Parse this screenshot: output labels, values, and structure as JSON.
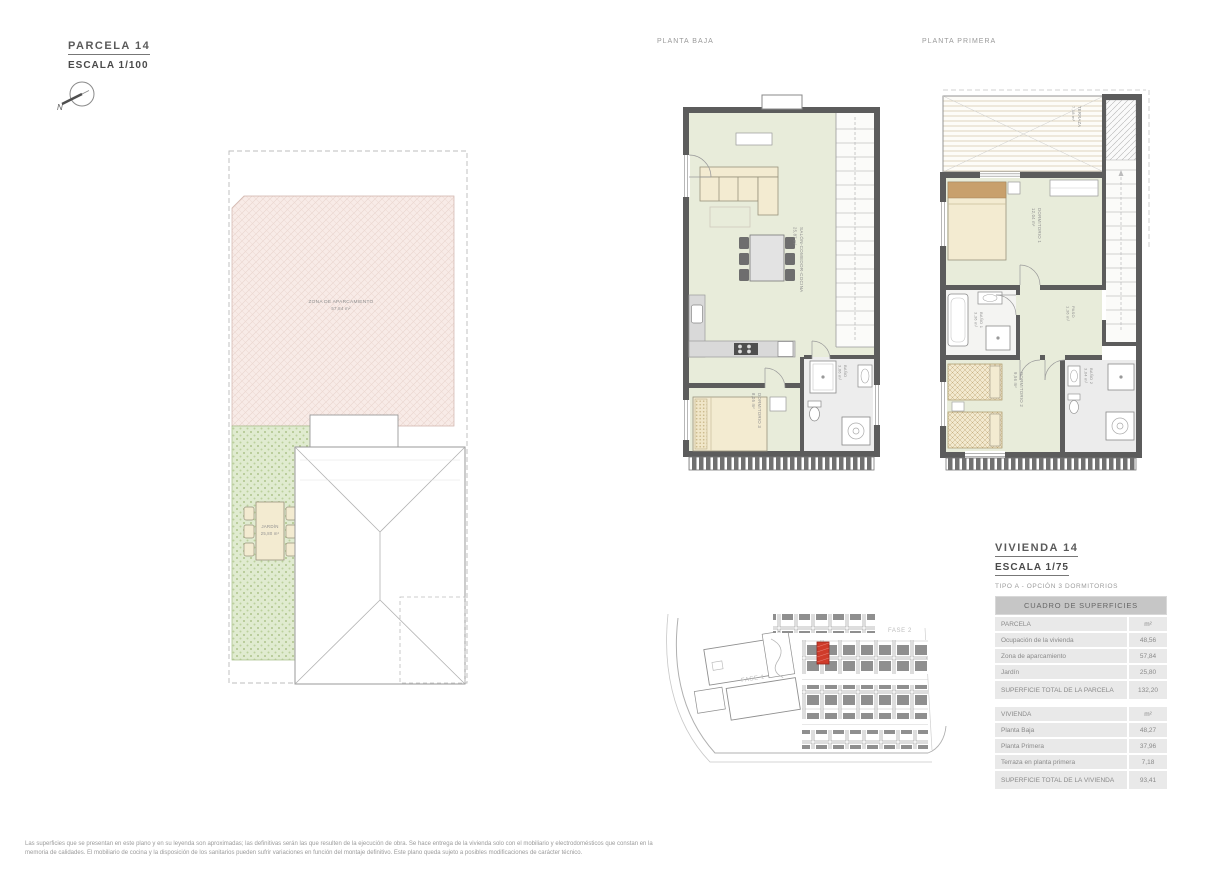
{
  "header": {
    "parcela_title": "PARCELA 14",
    "parcela_scale": "ESCALA 1/100",
    "north": "N"
  },
  "plan_labels": {
    "planta_baja": "PLANTA BAJA",
    "planta_primera": "PLANTA PRIMERA"
  },
  "site_plan": {
    "aparcamiento": {
      "label": "ZONA DE APARCAMIENTO",
      "area": "57,84 m²"
    },
    "jardin": {
      "label": "JARDÍN",
      "area": "25,80 m²"
    }
  },
  "planta_baja": {
    "salon": {
      "label": "SALÓN-COMEDOR-COCINA",
      "area": "25,87 m²"
    },
    "dormitorio3": {
      "label": "DORMITORIO 3",
      "area": "8,05 m²"
    },
    "bano": {
      "label": "BAÑO",
      "area": "3,66 m²"
    }
  },
  "planta_primera": {
    "terraza": {
      "label": "TERRAZA",
      "area": "7,18 m²"
    },
    "dormitorio1": {
      "label": "DORMITORIO 1",
      "area": "12,04 m²"
    },
    "bano1": {
      "label": "BAÑO 1",
      "area": "3,36 m²"
    },
    "paso": {
      "label": "PASO",
      "area": "1,36 m²"
    },
    "dormitorio2": {
      "label": "DORMITORIO 2",
      "area": "9,56 m²"
    },
    "bano2": {
      "label": "BAÑO 2",
      "area": "3,04 m²"
    }
  },
  "location_map": {
    "fase1": "FASE 1",
    "fase2": "FASE 2"
  },
  "vivienda": {
    "title": "VIVIENDA 14",
    "scale": "ESCALA 1/75",
    "tipo": "TIPO A - OPCIÓN 3 DORMITORIOS"
  },
  "surfaces_table": {
    "title": "CUADRO DE SUPERFICIES",
    "unit": "m²",
    "parcela_header": "PARCELA",
    "parcela_rows": [
      {
        "label": "Ocupación de la vivienda",
        "value": "48,56"
      },
      {
        "label": "Zona de aparcamiento",
        "value": "57,84"
      },
      {
        "label": "Jardín",
        "value": "25,80"
      },
      {
        "label": "SUPERFICIE TOTAL DE LA PARCELA",
        "value": "132,20"
      }
    ],
    "vivienda_header": "VIVIENDA",
    "vivienda_rows": [
      {
        "label": "Planta Baja",
        "value": "48,27"
      },
      {
        "label": "Planta Primera",
        "value": "37,96"
      },
      {
        "label": "Terraza en planta primera",
        "value": "7,18"
      },
      {
        "label": "SUPERFICIE TOTAL DE LA VIVIENDA",
        "value": "93,41"
      }
    ]
  },
  "footer": {
    "disclaimer": "Las superficies que se presentan en este plano y en su leyenda son aproximadas; las definitivas serán las que resulten de la ejecución de obra. Se hace entrega de la vivienda solo con el mobiliario y electrodomésticos que constan en la memoria de calidades. El mobiliario de cocina y la disposición de los sanitarios pueden sufrir variaciones en función del montaje definitivo. Este plano queda sujeto a posibles modificaciones de carácter técnico."
  },
  "colors": {
    "wall": "#5c5c5c",
    "floor_green": "#e8ecda",
    "furniture_cream": "#f3ebd1",
    "aparcamiento_pink": "#f8ebe7",
    "jardin_green": "#e0ebd0",
    "highlight_red": "#cf3b2a",
    "table_header_bg": "#c6c6c6",
    "table_row_bg": "#e9e9e9"
  }
}
